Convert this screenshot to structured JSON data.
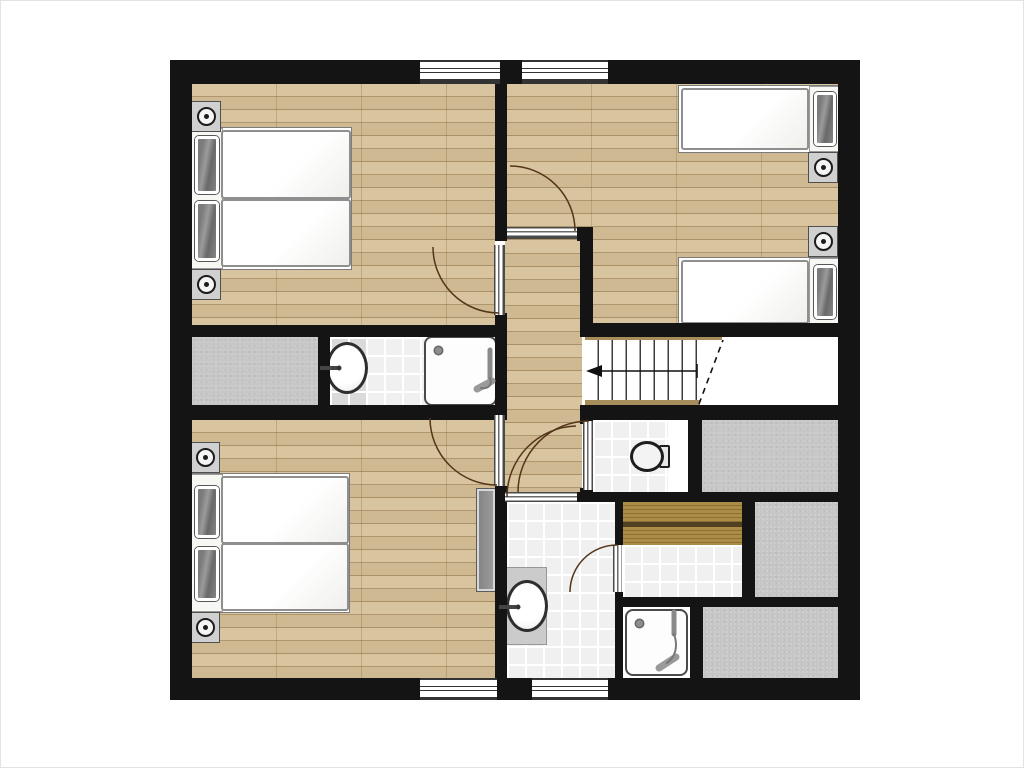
{
  "title": "upper-floor-plan",
  "colors": {
    "background": "#ffffff",
    "wall": "#141414",
    "wood": "#d5bf97",
    "carpet": "#c6c6c6",
    "tile": "#f0f0f0",
    "bench_dark": "#4f4122",
    "stair_wood": "#a78d5c",
    "arc": "#53351a",
    "metal": "#8a8a8a"
  },
  "rooms": [
    {
      "id": "bedroom-top-left",
      "floor": "wood",
      "furniture": [
        "double-bed",
        "nightstand-with-lamp",
        "nightstand-with-lamp"
      ],
      "openings": [
        "window-top",
        "door-to-hallway"
      ]
    },
    {
      "id": "bedroom-top-right",
      "floor": "wood",
      "furniture": [
        "single-bed",
        "single-bed",
        "nightstand-with-lamp",
        "nightstand-with-lamp"
      ],
      "openings": [
        "window-top",
        "door-to-hallway"
      ]
    },
    {
      "id": "bedroom-bottom-left",
      "floor": "wood",
      "furniture": [
        "double-bed",
        "nightstand-with-lamp",
        "nightstand-with-lamp",
        "wardrobe"
      ],
      "openings": [
        "window-bottom",
        "door-to-hallway"
      ]
    },
    {
      "id": "hallway",
      "floor": "wood",
      "openings": [
        "door-bedroom-top-left",
        "door-bedroom-top-right",
        "door-bedroom-bottom-left",
        "door-wc",
        "door-bathroom",
        "stairs"
      ]
    },
    {
      "id": "staircase",
      "features": [
        "treads",
        "up-direction-arrow",
        "dashed-break-line",
        "stairwell-void"
      ]
    },
    {
      "id": "ensuite-bathroom",
      "floor": "tile",
      "fixtures": [
        "washbasin",
        "shower-tray"
      ]
    },
    {
      "id": "wc",
      "floor": "tile",
      "fixtures": [
        "toilet"
      ]
    },
    {
      "id": "main-bathroom",
      "floor": "tile",
      "fixtures": [
        "washbasin"
      ],
      "openings": [
        "window-bottom",
        "door-to-hallway",
        "door-to-sauna"
      ]
    },
    {
      "id": "sauna",
      "floor": "tile",
      "fixtures": [
        "bench",
        "bench"
      ]
    },
    {
      "id": "shower-room",
      "floor": "tile",
      "fixtures": [
        "shower-tray"
      ]
    },
    {
      "id": "storage-left",
      "floor": "carpet"
    },
    {
      "id": "storage-right-upper",
      "floor": "carpet"
    },
    {
      "id": "storage-right-middle",
      "floor": "carpet"
    },
    {
      "id": "storage-right-lower",
      "floor": "carpet"
    }
  ],
  "window_count": 4,
  "door_count": 6,
  "bed_count": 4
}
